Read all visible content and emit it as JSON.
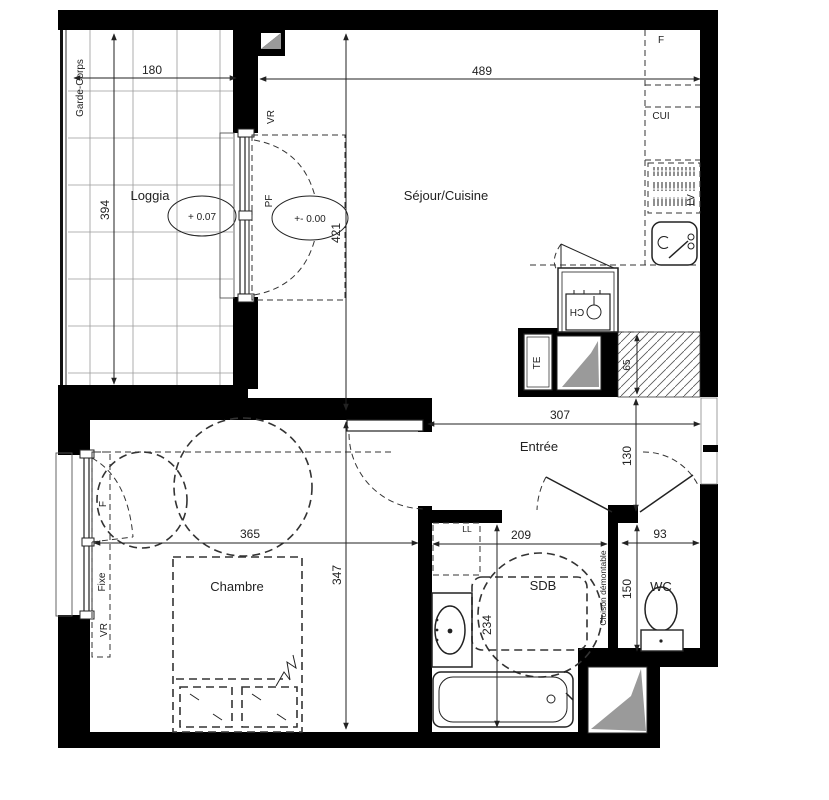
{
  "plan": {
    "rooms": {
      "loggia": {
        "label": "Loggia",
        "level": "+ 0.07"
      },
      "sejour": {
        "label": "Séjour/Cuisine",
        "level": "+- 0.00"
      },
      "entree": {
        "label": "Entrée"
      },
      "chambre": {
        "label": "Chambre"
      },
      "sdb": {
        "label": "SDB"
      },
      "wc": {
        "label": "WC"
      }
    },
    "dims": {
      "loggia_w": "180",
      "loggia_h": "394",
      "sejour_w": "489",
      "sejour_h": "421",
      "entree_w": "307",
      "entree_h": "130",
      "chambre_w": "365",
      "chambre_h": "347",
      "sdb_w": "209",
      "sdb_h": "234",
      "wc_w": "93",
      "wc_h": "150",
      "shaft_h": "65"
    },
    "tags": {
      "garde_corps": "Garde-Corps",
      "vr": "VR",
      "pf": "PF",
      "fridge": "F",
      "cui": "CUI",
      "lv": "LV",
      "ch": "CH",
      "te": "TE",
      "ll": "LL",
      "window_f": "F",
      "fixe": "Fixe",
      "vr_left": "VR",
      "cloison": "Cloison démontable"
    },
    "colors": {
      "wall": "#000000",
      "gray": "#9a9a9a",
      "line": "#222222"
    }
  }
}
